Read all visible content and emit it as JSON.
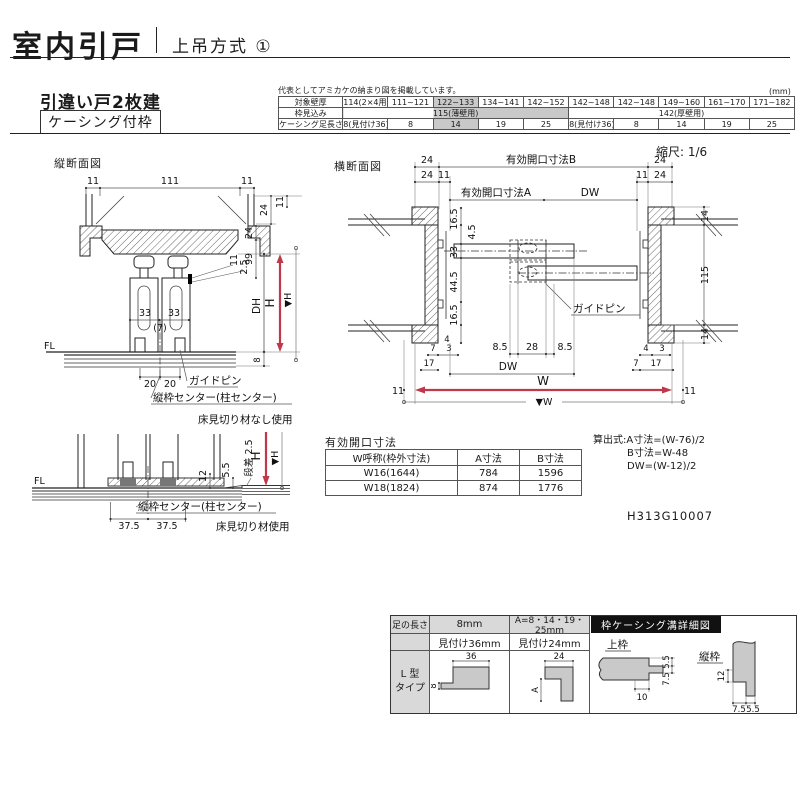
{
  "header": {
    "title": "室内引戸",
    "subtitle": "上吊方式 ①"
  },
  "product": {
    "name": "引違い戸2枚建",
    "frame": "ケーシング付枠"
  },
  "spec_table": {
    "note": "代表としてアミカケの納まり図を掲載しています。",
    "unit": "(mm)",
    "row1_label": "対象壁厚",
    "row2_label": "枠見込み",
    "row3_label": "ケーシング足長さ",
    "wall": [
      "114(2×4用)",
      "111~121",
      "122~133",
      "134~141",
      "142~152",
      "142~148",
      "142~148",
      "149~160",
      "161~170",
      "171~182"
    ],
    "depth": [
      "115(薄壁用)",
      "142(厚壁用)"
    ],
    "leg": [
      "8(見付け36)",
      "8",
      "14",
      "19",
      "25",
      "8(見付け36)",
      "8",
      "14",
      "19",
      "25"
    ]
  },
  "sections": {
    "vertical": "縦断面図",
    "horizontal": "横断面図",
    "scale": "縮尺: 1/6"
  },
  "vs": {
    "top_left": "11",
    "top_center": "111",
    "top_right": "11",
    "r24a": "24",
    "r11a": "11",
    "r24b": "24",
    "r99": "99",
    "r11b": "11",
    "r25": "2.5",
    "w33l": "33",
    "w33r": "33",
    "gap7": "(7)",
    "fl": "FL",
    "p20l": "20",
    "p20r": "20",
    "dh": "DH",
    "h": "H",
    "hv": "▼H",
    "f8": "8",
    "guide_pin": "ガイドピン",
    "center_label": "縦枠センター(柱センター)",
    "caption": "床見切り材なし使用"
  },
  "ts": {
    "fl": "FL",
    "step": "段差 2.5",
    "d55": "5.5",
    "d12": "12",
    "h": "H",
    "hv": "▼H",
    "d375l": "37.5",
    "d375r": "37.5",
    "center_label": "縦枠センター(柱センター)",
    "caption": "床見切り材使用"
  },
  "hs": {
    "t24l": "24",
    "openB": "有効開口寸法B",
    "t24r": "24",
    "b24l": "24",
    "b11l": "11",
    "b11r": "11",
    "b24r": "24",
    "openA": "有効開口寸法A",
    "dw_top": "DW",
    "l165a": "16.5",
    "l45": "4.5",
    "l33": "33",
    "l445": "44.5",
    "l165b": "16.5",
    "l4": "4",
    "l7": "7",
    "l3": "3",
    "l17": "17",
    "c85l": "8.5",
    "c28": "28",
    "c85r": "8.5",
    "guide_pin": "ガイドピン",
    "r14t": "14",
    "r115": "115",
    "r14b": "14",
    "r4": "4",
    "r3": "3",
    "r7": "7",
    "r17": "17",
    "dw_bottom": "DW",
    "w11l": "11",
    "w": "W",
    "w11r": "11",
    "wv": "▼W"
  },
  "opening_table": {
    "title": "有効開口寸法",
    "h_name": "W呼称(枠外寸法)",
    "h_a": "A寸法",
    "h_b": "B寸法",
    "rows": [
      [
        "W16(1644)",
        "784",
        "1596"
      ],
      [
        "W18(1824)",
        "874",
        "1776"
      ]
    ]
  },
  "formulas": {
    "line1": "算出式:A寸法=(W-76)/2",
    "line2": "B寸法=W-48",
    "line3": "DW=(W-12)/2"
  },
  "doc_number": "H313G10007",
  "leg_table": {
    "col1": "足の長さ",
    "col2": "8mm",
    "col3": "A=8・14・19・25mm",
    "sub2": "見付け36mm",
    "sub3": "見付け24mm",
    "type_line1": "L 型",
    "type_line2": "タイプ",
    "p36": "36",
    "p8": "8",
    "p24": "24",
    "pA": "A",
    "detail_title": "枠ケーシング溝詳細図",
    "top_frame": "上枠",
    "tf55": "5.5",
    "tf75": "7.5",
    "tf10": "10",
    "side_frame": "縦枠",
    "sf12": "12",
    "sf75": "7.5",
    "sf55": "5.5"
  },
  "colors": {
    "accent_red": "#c0394b",
    "shade_gray": "#c9c9c9"
  }
}
